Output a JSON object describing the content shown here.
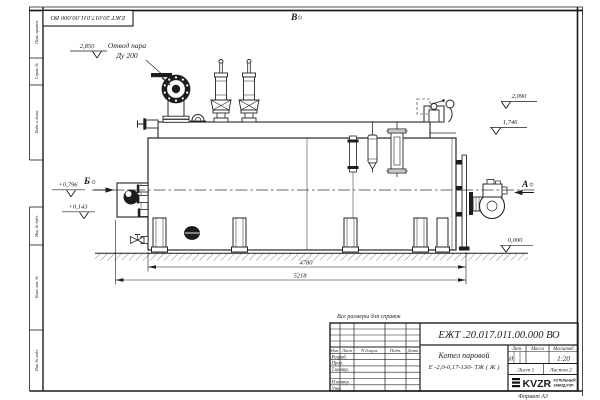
{
  "colors": {
    "line": "#222222",
    "background": "#ffffff"
  },
  "stamp_top": {
    "designation_inverted": "ЕЖТ 20.017.011.00.000 ВО"
  },
  "callouts": {
    "steam_line1": "Отвод пара",
    "steam_line2": "Ду 200",
    "elev_2850": "2,850",
    "elev_2090": "2,090",
    "elev_1746": "1,746",
    "elev_0796": "+0,796",
    "elev_0143": "+0,143",
    "elev_0000": "0,000",
    "view_top": "В",
    "view_left": "Б",
    "view_right": "А",
    "dim_body": "4780",
    "dim_overall": "5218",
    "note": "Все размеры для справок"
  },
  "title_block": {
    "designation": "ЕЖТ .20.017.011.00.000 ВО",
    "product_name": "Котел паровой",
    "product_type": "Е -2,0-0,17-130- ТЖ ( Ж )",
    "col_lit": "Лит.",
    "col_mass": "Масса",
    "col_scale": "Масштаб",
    "lit_value": "И",
    "scale_value": "1:20",
    "sheet": "Лист 1",
    "sheets": "Листов 2",
    "sign_header": [
      "Изм.",
      "Лист",
      "N докум.",
      "Подп.",
      "Дата"
    ],
    "sign_rows": [
      "Разраб.",
      "Пров.",
      "Т.контр.",
      "",
      "Н.контр.",
      "Утв."
    ],
    "logo_text": "KVZR",
    "logo_sub1": "КОТЕЛЬНЫЙ",
    "logo_sub2": "ЗАВОД РЭП",
    "format_note": "Формат А3"
  },
  "margin_columns": [
    "Перв. примен.",
    "Справ. №",
    "Подп. и дата",
    "Инв. № дубл.",
    "Взам. инв. №",
    "Инв. № подл."
  ]
}
